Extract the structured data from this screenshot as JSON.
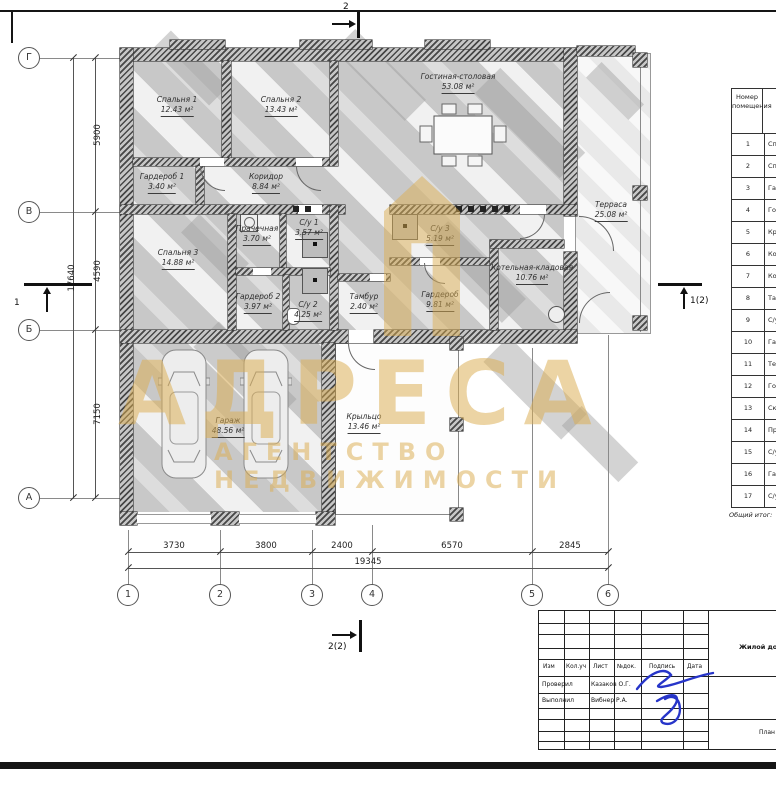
{
  "watermark": {
    "title": "АДРЕСА",
    "subtitle": "АГЕНТСТВО НЕДВИЖИМОСТИ"
  },
  "sections": {
    "top": "2",
    "bottom": "2(2)",
    "left": "1",
    "right": "1(2)"
  },
  "axes_bottom": [
    "1",
    "2",
    "3",
    "4",
    "5",
    "6"
  ],
  "axes_left": [
    "Г",
    "В",
    "Б",
    "А"
  ],
  "dims": {
    "bottom": [
      "3730",
      "3800",
      "2400",
      "6570",
      "2845"
    ],
    "bottom_total": "19345",
    "left": [
      "5900",
      "4590",
      "7150"
    ],
    "left_total": "17640"
  },
  "rooms": {
    "bedroom1": {
      "name": "Спальня 1",
      "area": "12.43 м²"
    },
    "bedroom2": {
      "name": "Спальня 2",
      "area": "13.43 м²"
    },
    "living": {
      "name": "Гостиная-столовая",
      "area": "53.08 м²"
    },
    "wardrobe1": {
      "name": "Гардероб 1",
      "area": "3.40 м²"
    },
    "corridor": {
      "name": "Коридор",
      "area": "8.84 м²"
    },
    "bedroom3": {
      "name": "Спальня 3",
      "area": "14.88 м²"
    },
    "laundry": {
      "name": "Прачечная",
      "area": "3.70 м²"
    },
    "bath1": {
      "name": "С/у 1",
      "area": "3.57 м²"
    },
    "wardrobe2": {
      "name": "Гардероб 2",
      "area": "3.97 м²"
    },
    "bath2": {
      "name": "С/у 2",
      "area": "4.25 м²"
    },
    "vestibule": {
      "name": "Тамбур",
      "area": "2.40 м²"
    },
    "bath3": {
      "name": "С/у 3",
      "area": "5.19 м²"
    },
    "wardrobe3": {
      "name": "Гардероб",
      "area": "9.81 м²"
    },
    "boiler": {
      "name": "Котельная-кладовая",
      "area": "10.76 м²"
    },
    "terrace": {
      "name": "Терраса",
      "area": "25.08 м²"
    },
    "garage": {
      "name": "Гараж",
      "area": "48.56 м²"
    },
    "porch": {
      "name": "Крыльцо",
      "area": "13.46 м²"
    }
  },
  "room_table": {
    "header": "Номер помещения",
    "rows": [
      [
        "1",
        "Сп"
      ],
      [
        "2",
        "Сп"
      ],
      [
        "3",
        "Гар"
      ],
      [
        "4",
        "Гос"
      ],
      [
        "5",
        "Кр"
      ],
      [
        "6",
        "Ко"
      ],
      [
        "7",
        "Кор"
      ],
      [
        "8",
        "Там"
      ],
      [
        "9",
        "С/у"
      ],
      [
        "10",
        "Гар"
      ],
      [
        "11",
        "Тер"
      ],
      [
        "12",
        "Гос"
      ],
      [
        "13",
        "Ск"
      ],
      [
        "14",
        "Пра"
      ],
      [
        "15",
        "С/у"
      ],
      [
        "16",
        "Гар"
      ],
      [
        "17",
        "С/у"
      ]
    ],
    "footer": "Общий итог:"
  },
  "title_block": {
    "columns": [
      "Изм",
      "Кол.уч",
      "Лист",
      "№док.",
      "Подпись",
      "Дата"
    ],
    "checked_label": "Проверил",
    "checked_name": "Казаков О.Г.",
    "author_label": "Выполнил",
    "author_name": "Вибнер Р.А.",
    "project": "Жилой дом",
    "note": "План на"
  }
}
